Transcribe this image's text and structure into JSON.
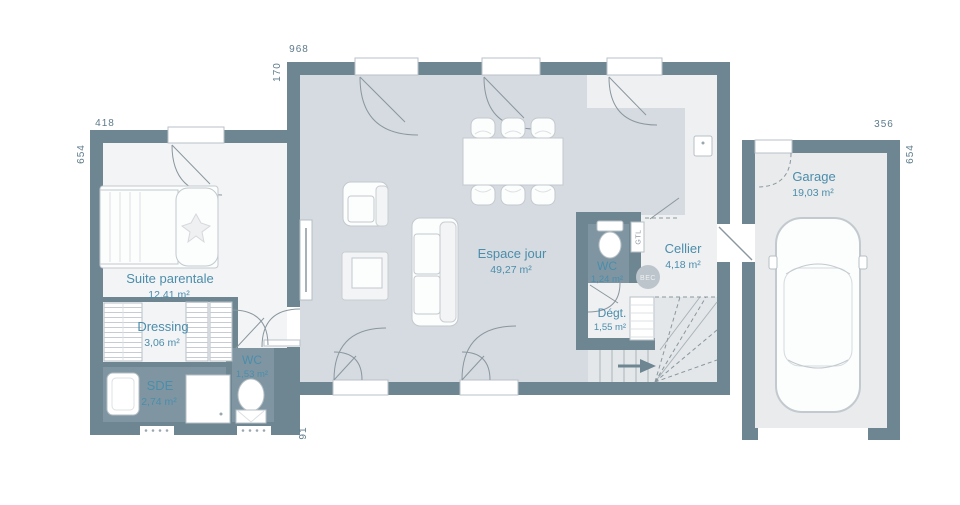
{
  "palette": {
    "wall": "#6e8592",
    "floor_living": "#d5dbe0",
    "floor_light": "#f3f4f6",
    "floor_wet": "#7f96a2",
    "floor_garage": "#e9ebec",
    "floor_stairs": "#e3e7ea",
    "floor_white": "#eff0f2",
    "line": "#8a979e",
    "label": "#4b8dab",
    "dim": "#5d7b8b"
  },
  "rooms": {
    "suite": {
      "name": "Suite parentale",
      "area": "12,41 m²"
    },
    "dressing": {
      "name": "Dressing",
      "area": "3,06 m²"
    },
    "sde": {
      "name": "SDE",
      "area": "2,74 m²"
    },
    "wc1": {
      "name": "WC",
      "area": "1,53 m²"
    },
    "espace_jour": {
      "name": "Espace jour",
      "area": "49,27 m²"
    },
    "wc2": {
      "name": "WC",
      "area": "1,24 m²"
    },
    "cellier": {
      "name": "Cellier",
      "area": "4,18 m²"
    },
    "degagement": {
      "name": "Dégt.",
      "area": "1,55 m²"
    },
    "garage": {
      "name": "Garage",
      "area": "19,03 m²"
    }
  },
  "annotations": {
    "gtl": "GTL",
    "bec": "BEC"
  },
  "dimensions": {
    "main_width_top": "968",
    "main_offset_left": "170",
    "suite_width_top": "418",
    "suite_height_left": "654",
    "garage_width_top": "356",
    "garage_height_right": "654",
    "bottom_left_offset": "91"
  }
}
